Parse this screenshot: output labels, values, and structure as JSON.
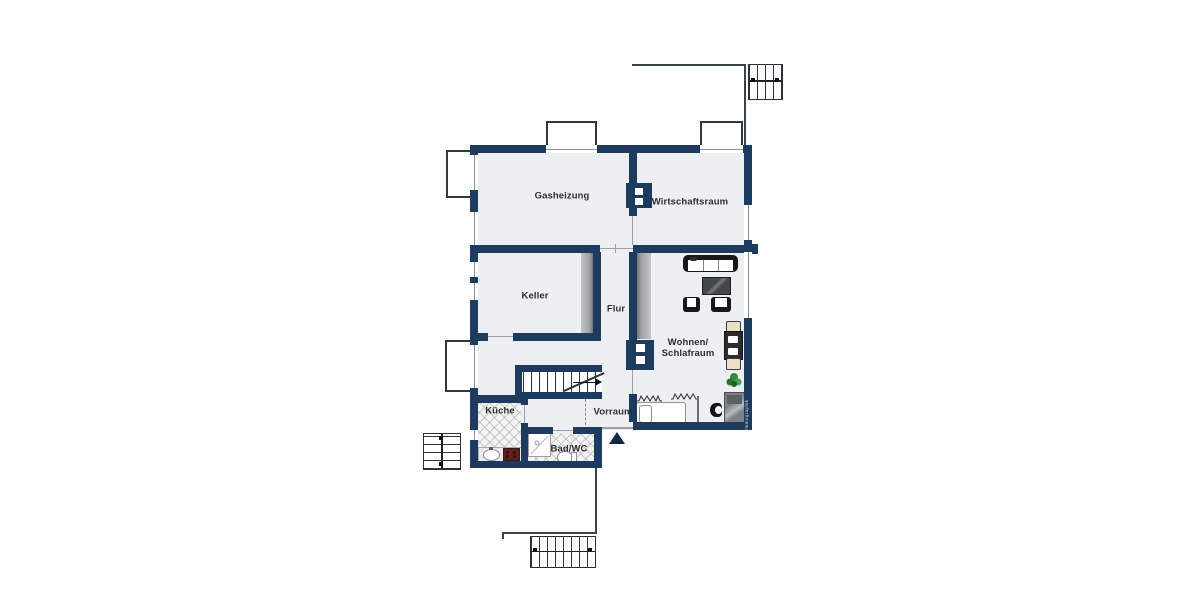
{
  "rooms": {
    "gasheizung": "Gasheizung",
    "wirtschaftsraum": "Wirtschaftsraum",
    "keller": "Keller",
    "flur": "Flur",
    "wohnen_schlafraum": "Wohnen/\nSchlafraum",
    "kueche": "Küche",
    "vorraum": "Vorraum",
    "bad_wc": "Bad/WC"
  },
  "watermark": "Immographik",
  "colors": {
    "wall": "#1d3b5f",
    "floor": "#edeff3",
    "outline": "#39424d",
    "cabinet_gray": "#a9acb0",
    "stove_red": "#6d1b15",
    "plant_green": "#3a8a3e"
  }
}
